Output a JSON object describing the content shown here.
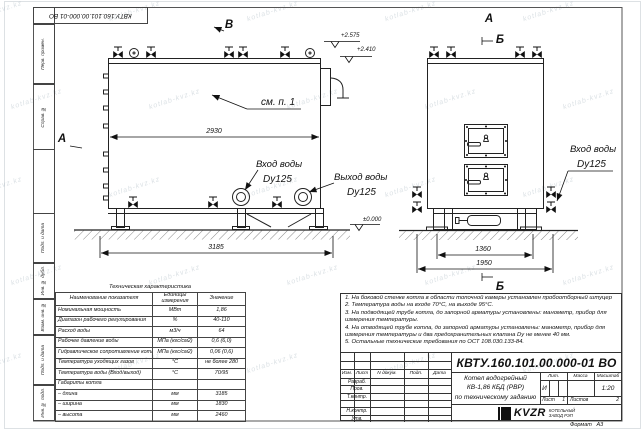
{
  "doc": {
    "number_rotated": "КВТУ.160.101.00.000-01 ВО",
    "watermark": "kotlab-kvz.kz"
  },
  "frame": {
    "stamps": [
      "Перв. примен.",
      "Справ. №",
      "Подп. и дата",
      "Инв. № дубл.",
      "Взам. инв. №",
      "Подп. и дата",
      "Инв. № подл."
    ]
  },
  "side_view": {
    "view_marker": "В",
    "section_marker": "А",
    "see_note": "см. п. 1",
    "dim_body_length": "2930",
    "dim_overall_length": "3185",
    "elevation_top": "+2.575",
    "elevation_upper": "+2.410",
    "elevation_ground": "±0.000",
    "inlet_line1": "Вход воды",
    "inlet_line2": "Dy125",
    "outlet_line1": "Выход воды",
    "outlet_line2": "Dy125"
  },
  "front_view": {
    "view_marker": "А",
    "section_marker_top": "Б",
    "section_marker_bottom": "Б",
    "dim_frame_width": "1360",
    "dim_overall_width": "1950",
    "inlet_line1": "Вход воды",
    "inlet_line2": "Dy125"
  },
  "notes": {
    "lines": [
      "1.  На боковой стенке котла в области топочной камеры установлен пробоотборный штуцер",
      "2.  Температура воды на входе 70°С, на выходе 95°С.",
      "3.  На подводящей трубе котла, до запорной арматуры установлены: манометр, прибор для",
      "измерения температуры.",
      "4.  На отводящей трубе котла, до запорной арматуры установлены: манометр, прибор для",
      "измерения температуры и два предохранительных клапана Dу не менее 40 мм.",
      "5.  Остальные технические требования по ОСТ 108.030.133-84."
    ]
  },
  "spec_table": {
    "title": "Техническая характеристика",
    "headers": [
      "Наименование показателя",
      "Единицы измерения",
      "Значение"
    ],
    "rows": [
      [
        "Номинальная мощность",
        "МВт",
        "1,86"
      ],
      [
        "Диапазон рабочего регулирования",
        "%",
        "40-110"
      ],
      [
        "Расход воды",
        "м3/ч",
        "64"
      ],
      [
        "Рабочее давление воды",
        "МПа (кгс/см2)",
        "0,6 (6,0)"
      ],
      [
        "Гидравлическое сопротивление котла",
        "МПа (кгс/см2)",
        "0,06 (0,6)"
      ],
      [
        "Температура уходящих газов",
        "°С",
        "не более 280"
      ],
      [
        "Температура воды (Вход/выход)",
        "°С",
        "70/95"
      ],
      [
        "Габариты котла",
        "",
        ""
      ],
      [
        "– длина",
        "мм",
        "3185"
      ],
      [
        "– ширина",
        "мм",
        "1830"
      ],
      [
        "– высота",
        "мм",
        "2460"
      ]
    ]
  },
  "title_block": {
    "doc_number": "КВТУ.160.101.00.000-01 ВО",
    "name_line1": "Котел водогрейный",
    "name_line2": "КВ-1,86 КБД (РВР)",
    "name_line3": "по техническому заданию",
    "grid_headers": [
      "Изм.",
      "Лист",
      "N докум.",
      "Подп.",
      "Дата"
    ],
    "row_labels": [
      "Разраб.",
      "Пров.",
      "Т.контр.",
      "",
      "Н.контр.",
      "Утв."
    ],
    "lit_label": "Лит.",
    "lit_value": "И",
    "mass_label": "Масса",
    "scale_label": "Масштаб",
    "scale_value": "1:20",
    "sheet_label": "Лист",
    "sheet_value": "1",
    "sheets_label": "Листов",
    "sheets_value": "2",
    "company_name": "KVZR",
    "company_sub1": "КОТЕЛЬНЫЙ",
    "company_sub2": "ЗАВОД РЭП",
    "format_label": "Формат",
    "format_value": "А3"
  }
}
